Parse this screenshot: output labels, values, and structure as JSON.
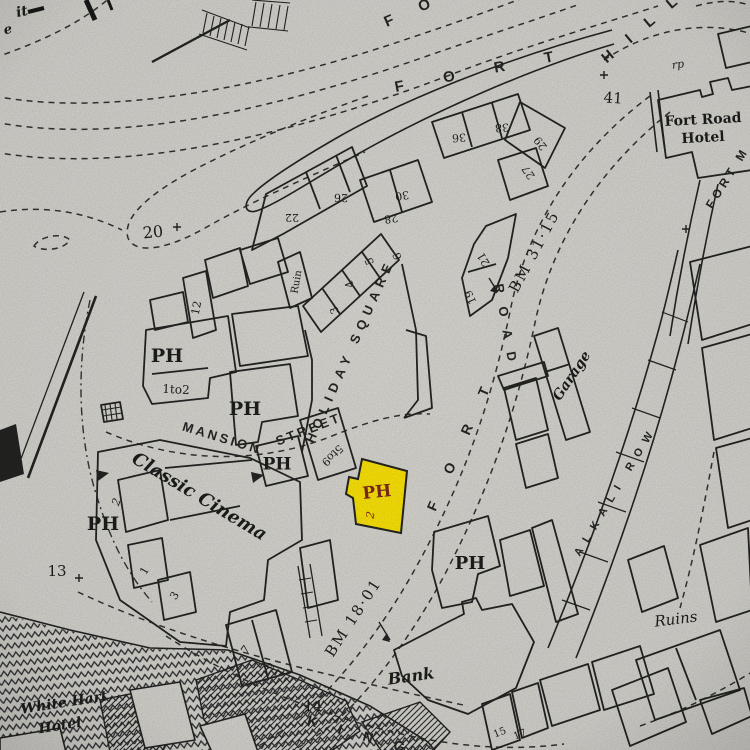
{
  "map": {
    "paper_color": "#d9d8d3",
    "ink_color": "#1d1d1d",
    "highlight": {
      "fill": "#ffe600",
      "stroke": "#1d1d1d",
      "label": "PH",
      "label_color": "#7b2318",
      "house_number": "2"
    },
    "labels": [
      {
        "n": "edge-fragment-1",
        "t": "it",
        "x": 22,
        "y": 12,
        "r": -12,
        "s": 14,
        "c": "sf sfi sfb"
      },
      {
        "n": "edge-fragment-2",
        "t": "e",
        "x": 8,
        "y": 30,
        "r": -12,
        "s": 13,
        "c": "sf sfi sfb"
      },
      {
        "n": "street-fort-hill-word-fort",
        "t": "F O R T",
        "x": 483,
        "y": 71,
        "r": -11,
        "s": 15,
        "ls": 18,
        "c": "st"
      },
      {
        "n": "street-fort-hill-word-hill",
        "t": "H I L L",
        "x": 643,
        "y": 28,
        "r": -40,
        "s": 15,
        "ls": 8,
        "c": "st"
      },
      {
        "n": "street-fort-partial",
        "t": "F O",
        "x": 413,
        "y": 11,
        "r": -24,
        "s": 15,
        "ls": 12,
        "c": "st"
      },
      {
        "n": "spot-height-41",
        "t": "41",
        "x": 613,
        "y": 99,
        "r": 4,
        "s": 15,
        "c": "sf"
      },
      {
        "n": "label-rp",
        "t": "rp",
        "x": 678,
        "y": 65,
        "r": -8,
        "s": 11,
        "c": "sf sfi"
      },
      {
        "n": "fort-road-hotel-line1",
        "t": "Fort Road",
        "x": 703,
        "y": 120,
        "r": -3,
        "s": 14,
        "c": "sf sfb"
      },
      {
        "n": "fort-road-hotel-line2",
        "t": "Hotel",
        "x": 703,
        "y": 138,
        "r": -3,
        "s": 14,
        "c": "sf sfb"
      },
      {
        "n": "street-fort-m",
        "t": "FORT M",
        "x": 728,
        "y": 178,
        "r": -58,
        "s": 12,
        "ls": 4,
        "c": "st"
      },
      {
        "n": "benchmark-bm-3115",
        "t": "BM 31·15",
        "x": 535,
        "y": 252,
        "r": -62,
        "s": 15,
        "ls": 2,
        "c": "sf"
      },
      {
        "n": "street-fort-road-word-fort",
        "t": "F O R T",
        "x": 462,
        "y": 443,
        "r": -66,
        "s": 14,
        "ls": 14,
        "c": "st"
      },
      {
        "n": "street-fort-road-word-road",
        "t": "R O A D",
        "x": 505,
        "y": 325,
        "r": 80,
        "s": 13,
        "ls": 5,
        "c": "st"
      },
      {
        "n": "street-holiday-square",
        "t": "HOLIDAY SQUARE",
        "x": 351,
        "y": 351,
        "r": -66,
        "s": 13,
        "ls": 6,
        "c": "st"
      },
      {
        "n": "street-mansion",
        "t": "MANSION",
        "x": 222,
        "y": 439,
        "r": 17,
        "s": 13,
        "ls": 3,
        "c": "st"
      },
      {
        "n": "street-mansion-street",
        "t": "STREET",
        "x": 309,
        "y": 430,
        "r": -21,
        "s": 13,
        "ls": 3,
        "c": "st"
      },
      {
        "n": "label-classic-cinema",
        "t": "Classic Cinema",
        "x": 199,
        "y": 497,
        "r": 31,
        "s": 18,
        "c": "sf sfi sfb"
      },
      {
        "n": "street-alkali-row",
        "t": "ALKALI ROW",
        "x": 616,
        "y": 491,
        "r": -59,
        "s": 11,
        "ls": 8,
        "c": "st"
      },
      {
        "n": "label-garage",
        "t": "Garage",
        "x": 572,
        "y": 376,
        "r": -56,
        "s": 14,
        "c": "sf sfi sfb"
      },
      {
        "n": "label-ruins",
        "t": "Ruins",
        "x": 676,
        "y": 620,
        "r": -7,
        "s": 15,
        "c": "sf sfi"
      },
      {
        "n": "label-bank",
        "t": "Bank",
        "x": 411,
        "y": 677,
        "r": -8,
        "s": 16,
        "c": "sf sfi sfb"
      },
      {
        "n": "benchmark-bm-1801",
        "t": "BM 18·01",
        "x": 354,
        "y": 618,
        "r": -57,
        "s": 15,
        "ls": 2,
        "c": "sf"
      },
      {
        "n": "label-white-hart-line1",
        "t": "White Hart",
        "x": 64,
        "y": 703,
        "r": -9,
        "s": 14,
        "c": "sf sfi sfb"
      },
      {
        "n": "label-white-hart-line2",
        "t": "Hotel",
        "x": 60,
        "y": 726,
        "r": -9,
        "s": 14,
        "c": "sf sfi sfb"
      },
      {
        "n": "street-king",
        "t": "K I N G",
        "x": 360,
        "y": 736,
        "r": 16,
        "s": 14,
        "ls": 9,
        "c": "st"
      },
      {
        "n": "spot-height-20",
        "t": "20",
        "x": 153,
        "y": 233,
        "r": -6,
        "s": 16,
        "c": "sf"
      },
      {
        "n": "spot-height-13",
        "t": "13",
        "x": 57,
        "y": 572,
        "r": 0,
        "s": 15,
        "c": "sf"
      },
      {
        "n": "spot-height-14",
        "t": "14",
        "x": 313,
        "y": 707,
        "r": 0,
        "s": 15,
        "c": "sf"
      },
      {
        "n": "ph-label-1",
        "t": "PH",
        "x": 167,
        "y": 357,
        "r": 0,
        "s": 19,
        "c": "sf sfb"
      },
      {
        "n": "ph-label-2",
        "t": "PH",
        "x": 245,
        "y": 410,
        "r": 0,
        "s": 19,
        "c": "sf sfb"
      },
      {
        "n": "ph-label-3",
        "t": "PH",
        "x": 277,
        "y": 465,
        "r": 0,
        "s": 17,
        "c": "sf sfb"
      },
      {
        "n": "ph-label-4",
        "t": "PH",
        "x": 103,
        "y": 525,
        "r": 0,
        "s": 19,
        "c": "sf sfb"
      },
      {
        "n": "ph-label-5",
        "t": "PH",
        "x": 470,
        "y": 564,
        "r": 0,
        "s": 18,
        "c": "sf sfb"
      },
      {
        "n": "ph-label-highlighted",
        "t": "PH",
        "x": 377,
        "y": 493,
        "r": -6,
        "s": 17,
        "c": "sf sfb red"
      },
      {
        "n": "house-number-2-highlighted",
        "t": "2",
        "x": 371,
        "y": 515,
        "r": -80,
        "s": 11,
        "c": "sf sfi red"
      },
      {
        "n": "label-1to2",
        "t": "1to2",
        "x": 176,
        "y": 390,
        "r": 3,
        "s": 12,
        "c": "sf"
      },
      {
        "n": "label-ruin",
        "t": "Ruin",
        "x": 297,
        "y": 282,
        "r": -80,
        "s": 10,
        "c": "sf"
      },
      {
        "n": "label-5to9",
        "t": "5to9",
        "x": 332,
        "y": 455,
        "r": 136,
        "s": 11,
        "c": "sf"
      },
      {
        "n": "house-number-22",
        "t": "22",
        "x": 292,
        "y": 217,
        "r": 180,
        "s": 11,
        "c": "sf"
      },
      {
        "n": "house-number-26",
        "t": "26",
        "x": 341,
        "y": 197,
        "r": 182,
        "s": 11,
        "c": "sf"
      },
      {
        "n": "house-number-28",
        "t": "28",
        "x": 391,
        "y": 218,
        "r": 172,
        "s": 11,
        "c": "sf"
      },
      {
        "n": "house-number-30",
        "t": "30",
        "x": 402,
        "y": 195,
        "r": 172,
        "s": 11,
        "c": "sf"
      },
      {
        "n": "house-number-36",
        "t": "36",
        "x": 459,
        "y": 137,
        "r": 176,
        "s": 11,
        "c": "sf"
      },
      {
        "n": "house-number-38",
        "t": "38",
        "x": 502,
        "y": 127,
        "r": 176,
        "s": 11,
        "c": "sf"
      },
      {
        "n": "house-number-29",
        "t": "29",
        "x": 541,
        "y": 143,
        "r": -128,
        "s": 11,
        "c": "sf"
      },
      {
        "n": "house-number-27",
        "t": "27",
        "x": 529,
        "y": 172,
        "r": -124,
        "s": 11,
        "c": "sf"
      },
      {
        "n": "house-number-21",
        "t": "21",
        "x": 484,
        "y": 259,
        "r": -120,
        "s": 11,
        "c": "sf"
      },
      {
        "n": "house-number-19",
        "t": "19",
        "x": 471,
        "y": 297,
        "r": -115,
        "s": 11,
        "c": "sf"
      },
      {
        "n": "house-number-6",
        "t": "6",
        "x": 398,
        "y": 256,
        "r": -112,
        "s": 11,
        "c": "sf"
      },
      {
        "n": "house-number-5",
        "t": "5",
        "x": 370,
        "y": 261,
        "r": -112,
        "s": 11,
        "c": "sf"
      },
      {
        "n": "house-number-4",
        "t": "4",
        "x": 350,
        "y": 284,
        "r": -112,
        "s": 11,
        "c": "sf"
      },
      {
        "n": "house-number-3-holiday",
        "t": "3",
        "x": 335,
        "y": 310,
        "r": -112,
        "s": 11,
        "c": "sf"
      },
      {
        "n": "house-number-12",
        "t": "12",
        "x": 197,
        "y": 308,
        "r": -78,
        "s": 11,
        "c": "sf"
      },
      {
        "n": "house-number-2-cinema",
        "t": "2",
        "x": 117,
        "y": 502,
        "r": -70,
        "s": 11,
        "c": "sf sfi"
      },
      {
        "n": "house-number-1-cinema",
        "t": "1",
        "x": 145,
        "y": 571,
        "r": -60,
        "s": 11,
        "c": "sf"
      },
      {
        "n": "house-number-3-cinema",
        "t": "3",
        "x": 175,
        "y": 596,
        "r": -58,
        "s": 11,
        "c": "sf"
      },
      {
        "n": "house-number-7",
        "t": "7",
        "x": 246,
        "y": 650,
        "r": -52,
        "s": 11,
        "c": "sf"
      },
      {
        "n": "house-number-9",
        "t": "9",
        "x": 271,
        "y": 667,
        "r": -52,
        "s": 11,
        "c": "sf"
      },
      {
        "n": "house-number-15",
        "t": "15",
        "x": 500,
        "y": 733,
        "r": -22,
        "s": 10,
        "c": "sf"
      },
      {
        "n": "house-number-17",
        "t": "17",
        "x": 520,
        "y": 735,
        "r": -22,
        "s": 10,
        "c": "sf"
      }
    ]
  }
}
